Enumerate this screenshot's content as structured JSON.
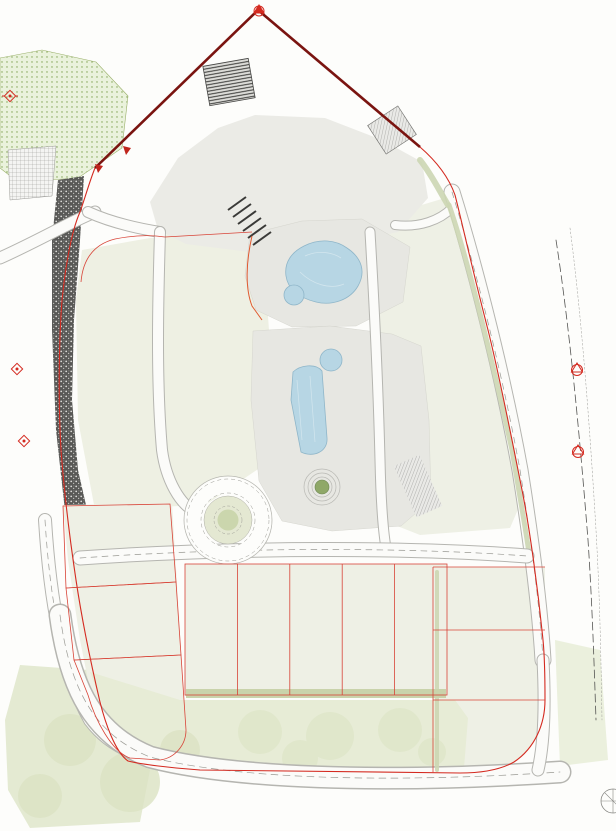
{
  "title": "Residential development site masterplan",
  "corner_stamp": {
    "line1": "AG. ATHANASIO",
    "line2": "MASTERPLA"
  },
  "faint_elevation": "116.84",
  "colors": {
    "label_red": "#e8221c",
    "boundary_red": "#d42a20",
    "boundary_dark_red": "#7a1410",
    "pool_blue": "#aecfdf",
    "tree_olive": "#7f9750",
    "tree_sage": "#acb795",
    "plaza_gray": "#e7e7e2",
    "landscape_green": "#eef0e3",
    "contour_gray": "#d2d2cd"
  },
  "parcel_labels": [
    {
      "text": "383",
      "x": 361,
      "y": 52
    },
    {
      "text": "385",
      "x": 456,
      "y": 127
    }
  ],
  "block_labels": [
    {
      "id": "A1",
      "text": "A1",
      "x": 196,
      "y": 108
    },
    {
      "id": "A2",
      "text": "A2",
      "x": 366,
      "y": 138
    },
    {
      "id": "B2",
      "text": "B2",
      "x": 263,
      "y": 312
    },
    {
      "id": "B1",
      "text": "B1",
      "x": 262,
      "y": 408
    },
    {
      "id": "C1",
      "text": "C1",
      "x": 489,
      "y": 288
    },
    {
      "id": "C2",
      "text": "C2",
      "x": 527,
      "y": 446
    }
  ],
  "unit_labels": [
    {
      "block": "A1",
      "text": "02",
      "x": 224,
      "y": 134
    },
    {
      "block": "A1",
      "text": "03",
      "x": 277,
      "y": 134
    },
    {
      "block": "A1",
      "text": "01",
      "x": 196,
      "y": 162
    },
    {
      "block": "A2",
      "text": "01",
      "x": 304,
      "y": 148
    },
    {
      "block": "A2",
      "text": "02",
      "x": 334,
      "y": 164
    },
    {
      "block": "A2",
      "text": "03",
      "x": 369,
      "y": 201
    },
    {
      "block": "TH",
      "text": "01",
      "x": 88,
      "y": 282
    },
    {
      "block": "TH",
      "text": "02",
      "x": 83,
      "y": 307
    },
    {
      "block": "TH",
      "text": "03",
      "x": 79,
      "y": 332
    },
    {
      "block": "TH",
      "text": "04",
      "x": 75,
      "y": 357
    },
    {
      "block": "TH",
      "text": "05",
      "x": 80,
      "y": 389
    },
    {
      "block": "TH",
      "text": "06",
      "x": 75,
      "y": 414
    },
    {
      "block": "TH",
      "text": "07",
      "x": 70,
      "y": 438
    },
    {
      "block": "TH",
      "text": "08",
      "x": 68,
      "y": 459
    },
    {
      "block": "TH",
      "text": "09",
      "x": 71,
      "y": 484
    },
    {
      "block": "B2",
      "text": "01",
      "x": 217,
      "y": 274
    },
    {
      "block": "B2",
      "text": "02",
      "x": 223,
      "y": 298
    },
    {
      "block": "B2",
      "text": "03",
      "x": 211,
      "y": 328
    },
    {
      "block": "B1",
      "text": "01",
      "x": 211,
      "y": 369
    },
    {
      "block": "B1",
      "text": "02",
      "x": 213,
      "y": 393
    },
    {
      "block": "B1",
      "text": "03",
      "x": 204,
      "y": 423
    },
    {
      "block": "C1",
      "text": "02",
      "x": 427,
      "y": 252
    },
    {
      "block": "C1",
      "text": "03",
      "x": 431,
      "y": 298
    },
    {
      "block": "C1",
      "text": "01",
      "x": 459,
      "y": 301
    },
    {
      "block": "C1",
      "text": "04",
      "x": 436,
      "y": 325
    },
    {
      "block": "C1",
      "text": "05",
      "x": 455,
      "y": 367
    },
    {
      "block": "C2",
      "text": "05",
      "x": 459,
      "y": 398
    },
    {
      "block": "C2",
      "text": "04",
      "x": 464,
      "y": 449
    },
    {
      "block": "C2",
      "text": "01",
      "x": 495,
      "y": 454
    },
    {
      "block": "C2",
      "text": "03",
      "x": 469,
      "y": 471
    },
    {
      "block": "C2",
      "text": "02",
      "x": 488,
      "y": 511
    }
  ],
  "villa_labels": [
    {
      "id": "villa-1",
      "lines": [
        "Villa",
        "1"
      ],
      "x": 80,
      "y": 543
    },
    {
      "id": "villa-2",
      "lines": [
        "Villa",
        "2"
      ],
      "x": 88,
      "y": 622
    },
    {
      "id": "villa-3",
      "lines": [
        "Villa",
        "3"
      ],
      "x": 101,
      "y": 707
    },
    {
      "id": "villa-5",
      "lines": [
        "Villa",
        "5"
      ],
      "x": 330,
      "y": 568
    },
    {
      "id": "villa-4c",
      "lines": [
        "Villa",
        "4C"
      ],
      "x": 546,
      "y": 597
    },
    {
      "id": "villa-4b",
      "lines": [
        "Villa",
        "4B"
      ],
      "x": 548,
      "y": 667
    },
    {
      "id": "villa-4a",
      "lines": [
        "Villa",
        "4A"
      ],
      "x": 483,
      "y": 776
    }
  ],
  "row_villa_labels": [
    {
      "text": "5-1",
      "x": 213,
      "y": 683
    },
    {
      "text": "5-2",
      "x": 260,
      "y": 682
    },
    {
      "text": "5-3",
      "x": 315,
      "y": 684
    },
    {
      "text": "5-4",
      "x": 370,
      "y": 682
    },
    {
      "text": "5-5",
      "x": 418,
      "y": 682
    }
  ],
  "site_labels": [
    {
      "text": "PUBLIC ROAD",
      "x": 123,
      "y": 205,
      "rot": -20,
      "size": 4
    },
    {
      "text": "PUBLIC ROAD",
      "x": 73,
      "y": 712,
      "rot": 68,
      "size": 4
    },
    {
      "text": "PUBLIC ROAD",
      "x": 215,
      "y": 801,
      "rot": 2,
      "size": 4
    },
    {
      "text": "PUBLIC ROAD",
      "x": 390,
      "y": 805,
      "rot": 1,
      "size": 4
    },
    {
      "text": "PUBLIC ROAD",
      "x": 550,
      "y": 721,
      "rot": 0,
      "size": 3.6
    },
    {
      "text": "PUBLIC ROAD",
      "x": 519,
      "y": 404,
      "rot": 72,
      "size": 3.4
    },
    {
      "text": "PUBLIC ROAD",
      "x": 484,
      "y": 287,
      "rot": 72,
      "size": 3.4
    },
    {
      "text": "PRIVATE ROAD",
      "x": 313,
      "y": 557,
      "rot": 0,
      "size": 4
    },
    {
      "text": "PRIVATE ROAD",
      "x": 497,
      "y": 554,
      "rot": 0,
      "size": 3.6
    },
    {
      "text": "SWIMMING POOL",
      "x": 328,
      "y": 280,
      "rot": -18,
      "size": 3.4
    },
    {
      "text": "SWIMMING POOL",
      "x": 309,
      "y": 417,
      "rot": 0,
      "size": 2.8
    },
    {
      "text": "KIDS POOL",
      "x": 300,
      "y": 300,
      "rot": 0,
      "size": 3
    },
    {
      "text": "KIDS POOL",
      "x": 331,
      "y": 363,
      "rot": 0,
      "size": 3
    },
    {
      "text": "VIEWING PLATFORM",
      "x": 322,
      "y": 487,
      "rot": 0,
      "size": 2.8
    },
    {
      "text": "PUBLIC GREEN",
      "x": 16,
      "y": 731,
      "rot": 0,
      "size": 3.2
    },
    {
      "text": "PUBLIC GREEN",
      "x": 433,
      "y": 731,
      "rot": 0,
      "size": 3.2
    },
    {
      "text": "PUBLIC COMMUNITY",
      "x": 213,
      "y": 729,
      "rot": 0,
      "size": 3
    },
    {
      "text": "SPACE",
      "x": 213,
      "y": 733,
      "rot": 0,
      "size": 3
    },
    {
      "text": "UNDERGROUND PARKING",
      "x": 263,
      "y": 76,
      "rot": 0,
      "size": 2.8
    },
    {
      "text": "ENTRANCE",
      "x": 263,
      "y": 80,
      "rot": 0,
      "size": 2.8
    },
    {
      "text": "POOL",
      "x": 96,
      "y": 572,
      "rot": -8,
      "size": 3
    },
    {
      "text": "POOL",
      "x": 155,
      "y": 649,
      "rot": 0,
      "size": 3
    },
    {
      "text": "POOL",
      "x": 137,
      "y": 747,
      "rot": 80,
      "size": 3
    },
    {
      "text": "POOL",
      "x": 518,
      "y": 622,
      "rot": -6,
      "size": 3
    },
    {
      "text": "POOL",
      "x": 512,
      "y": 692,
      "rot": -4,
      "size": 3
    },
    {
      "text": "POOL",
      "x": 523,
      "y": 734,
      "rot": 85,
      "size": 3
    },
    {
      "text": "POOL",
      "x": 205,
      "y": 681,
      "rot": 0,
      "size": 2.6
    },
    {
      "text": "POOL",
      "x": 257,
      "y": 681,
      "rot": 0,
      "size": 2.6
    },
    {
      "text": "POOL",
      "x": 310,
      "y": 681,
      "rot": 0,
      "size": 2.6
    },
    {
      "text": "POOL",
      "x": 362,
      "y": 681,
      "rot": 0,
      "size": 2.6
    },
    {
      "text": "POOL",
      "x": 415,
      "y": 681,
      "rot": 0,
      "size": 2.6
    },
    {
      "text": "COVERED PARKING",
      "x": 211,
      "y": 578,
      "rot": 0,
      "size": 2
    },
    {
      "text": "COVERED PARKING",
      "x": 263,
      "y": 578,
      "rot": 0,
      "size": 2
    },
    {
      "text": "COVERED PARKING",
      "x": 316,
      "y": 578,
      "rot": 0,
      "size": 2
    },
    {
      "text": "COVERED PARKING",
      "x": 368,
      "y": 578,
      "rot": 0,
      "size": 2
    },
    {
      "text": "COVERED PARKING",
      "x": 421,
      "y": 578,
      "rot": 0,
      "size": 2
    }
  ]
}
